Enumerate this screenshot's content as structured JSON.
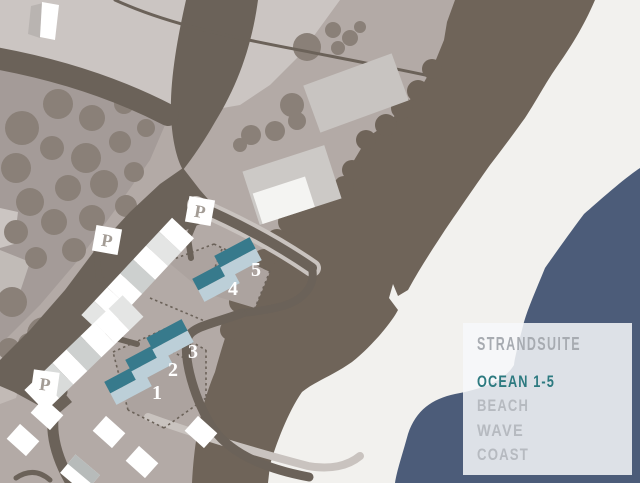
{
  "map": {
    "legend": {
      "title": "STRANDSUITE",
      "title_color": "#a7abb1",
      "items": [
        {
          "label": "OCEAN 1-5",
          "color": "#2d7a80"
        },
        {
          "label": "BEACH",
          "color": "#b6bac0"
        },
        {
          "label": "WAVE",
          "color": "#b6bac0"
        },
        {
          "label": "COAST",
          "color": "#b6bac0"
        }
      ]
    },
    "buildings": [
      {
        "label": "1"
      },
      {
        "label": "2"
      },
      {
        "label": "3"
      },
      {
        "label": "4"
      },
      {
        "label": "5"
      }
    ],
    "parking_label": "P",
    "colors": {
      "ocean": "#4c5c79",
      "beach": "#f2f1ee",
      "dune": "#6f6459",
      "land": "#b3aaa6",
      "land_light": "#cbc5c2",
      "field": "#a49b98",
      "tree": "#8a8078",
      "road": "#6b6259",
      "path_light": "#c9c3bf",
      "plot": "#aca39f",
      "roof_dark": "#377a8c",
      "roof_light": "#bccfd8",
      "building_white": "#ffffff",
      "building_gray": "#c8c4c1",
      "number": "#ffffff",
      "parking_letter": "#a39c95",
      "legend_bg": "#f7f8fa"
    }
  }
}
